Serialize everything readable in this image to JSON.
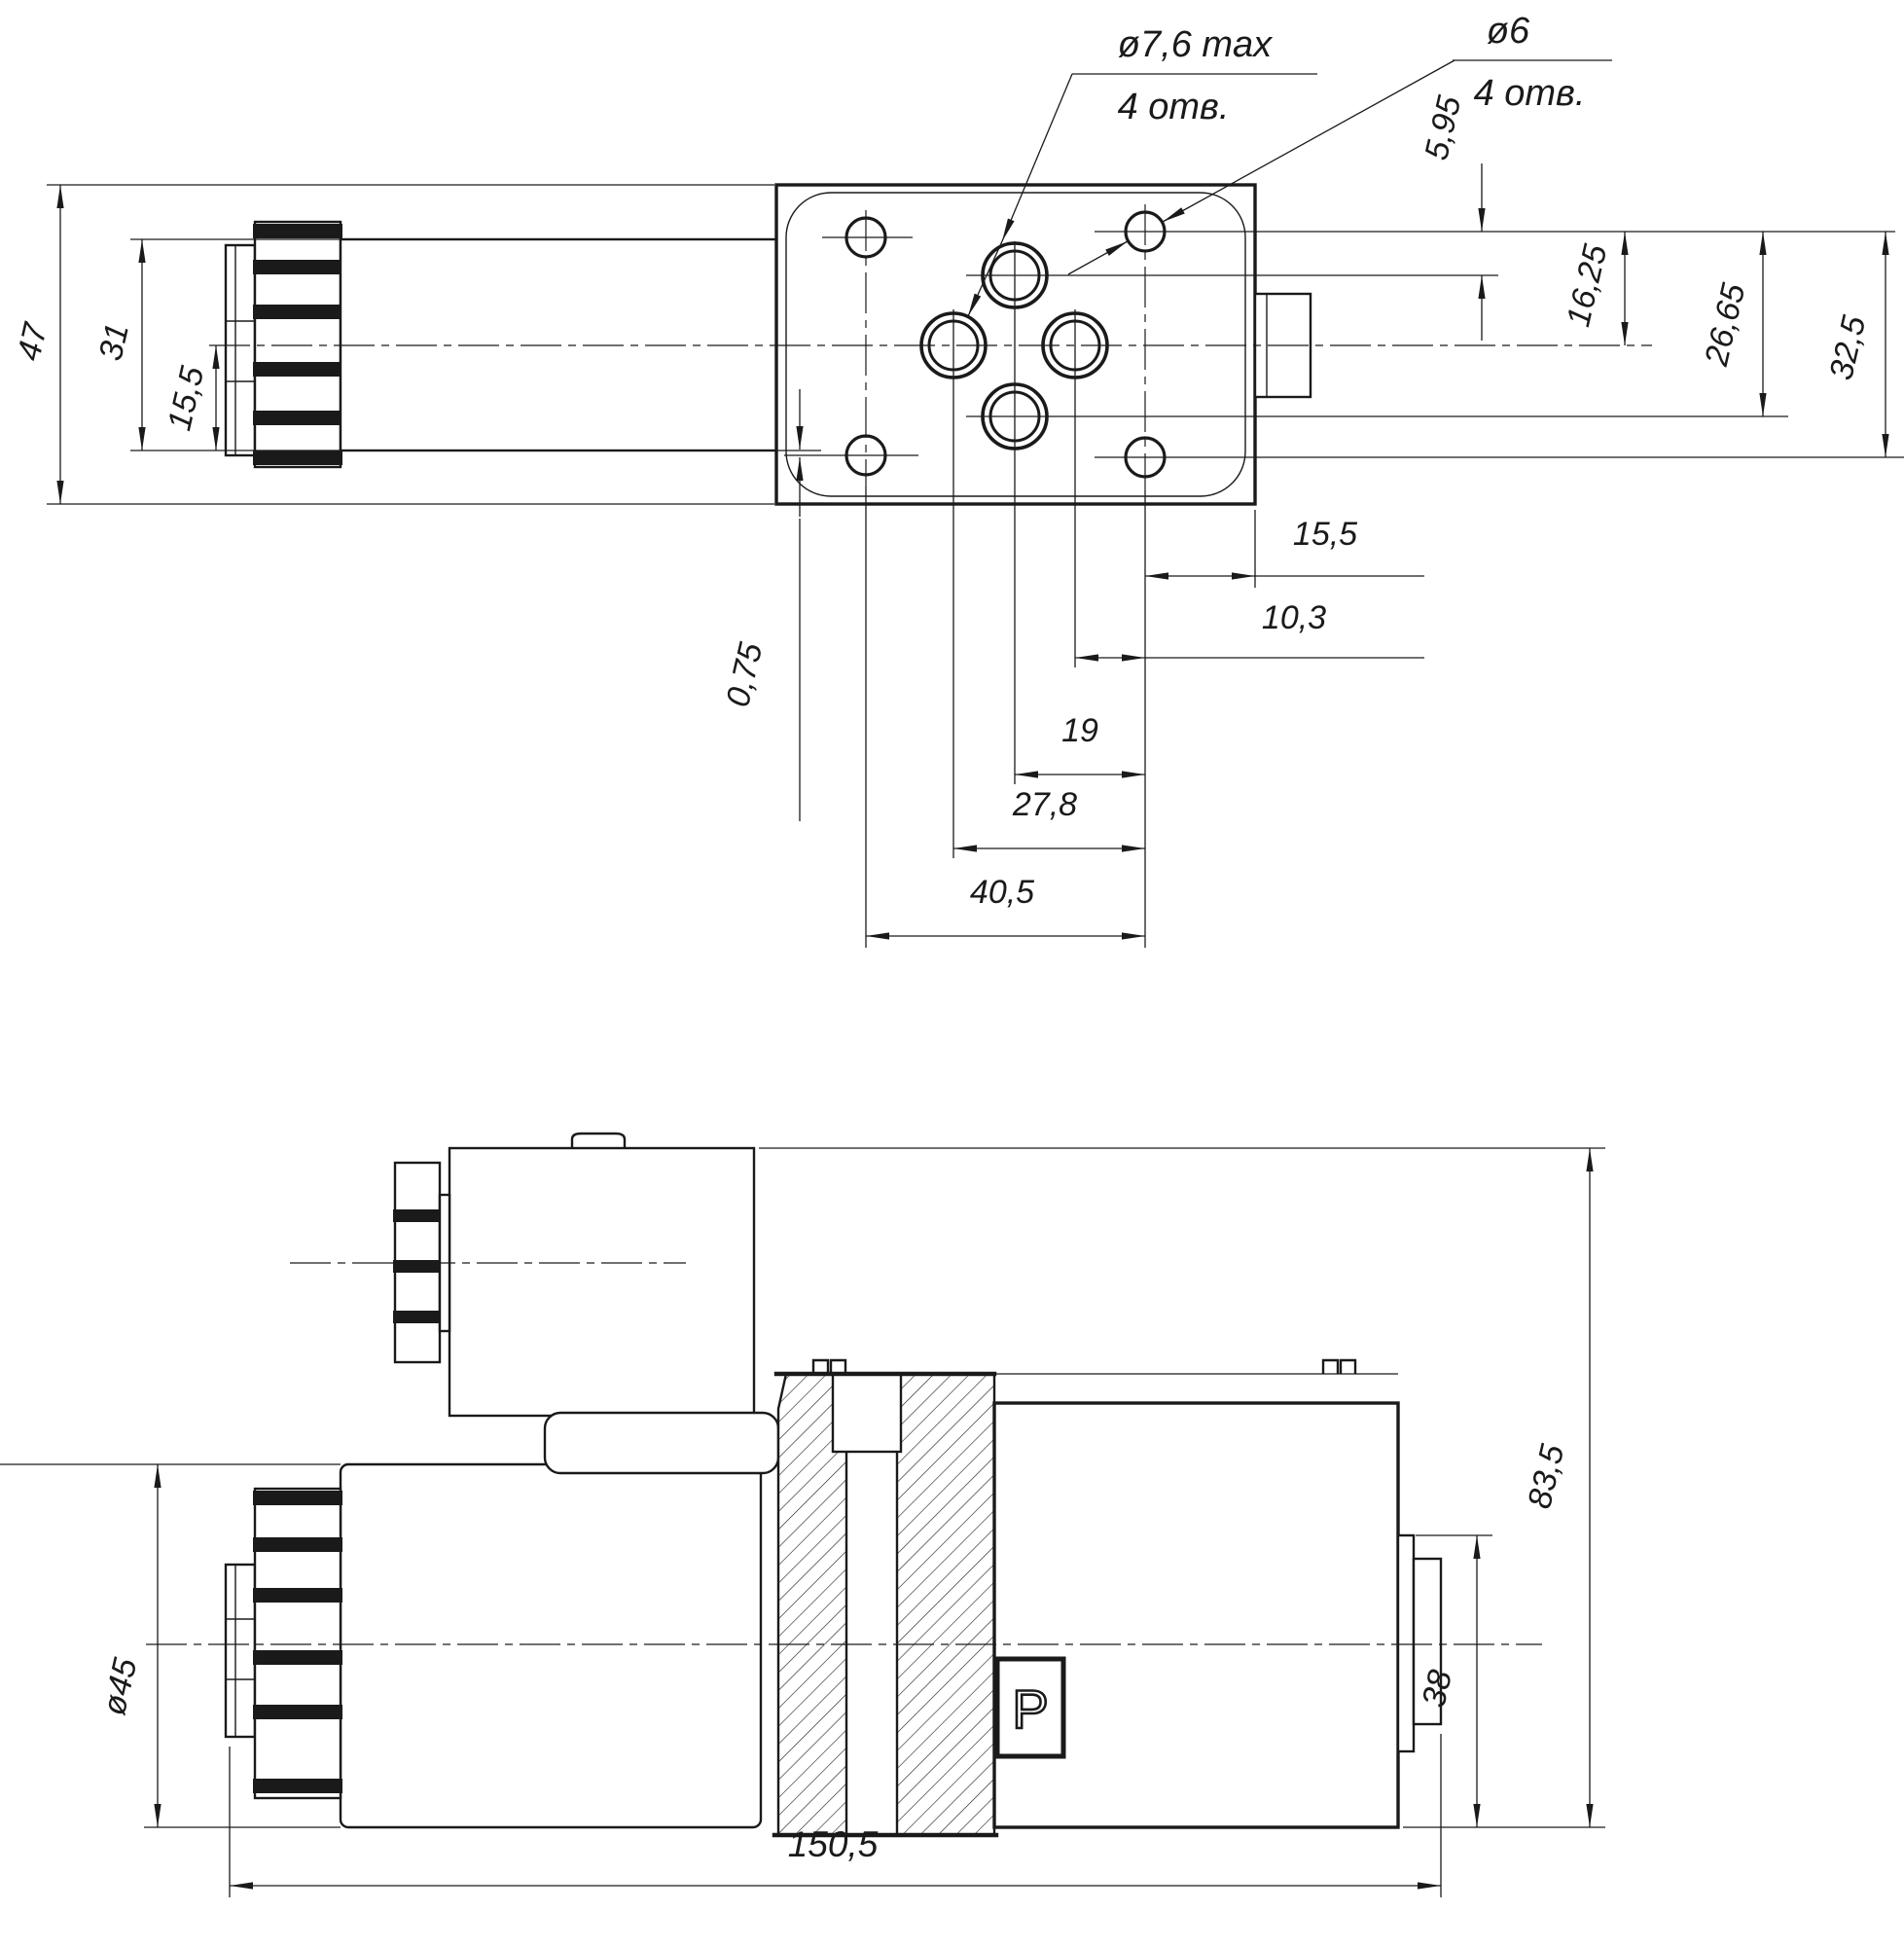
{
  "drawing": {
    "colors": {
      "line": "#1a1a1a",
      "background": "#ffffff"
    },
    "callouts": {
      "counterbore": {
        "diameter": "ø7,6 max",
        "holes": "4 отв."
      },
      "mounting": {
        "diameter": "ø6",
        "holes": "4 отв."
      }
    },
    "top_view": {
      "dims": {
        "overall_height": "47",
        "coil_height": "31",
        "axis_to_bottom": "15,5",
        "top_hole_offset": "5,95",
        "axis_offset": "16,25",
        "holes_span_mid": "26,65",
        "holes_span_full": "32,5",
        "edge_offset": "0,75",
        "right_margin": "15,5",
        "pitch_small": "10,3",
        "pitch_mid": "19",
        "pitch_large": "27,8",
        "mount_span": "40,5"
      }
    },
    "side_view": {
      "port_label": "P",
      "dims": {
        "coil_diameter": "ø45",
        "overall_height": "83,5",
        "port_face_height": "38",
        "overall_length": "150,5"
      }
    }
  }
}
